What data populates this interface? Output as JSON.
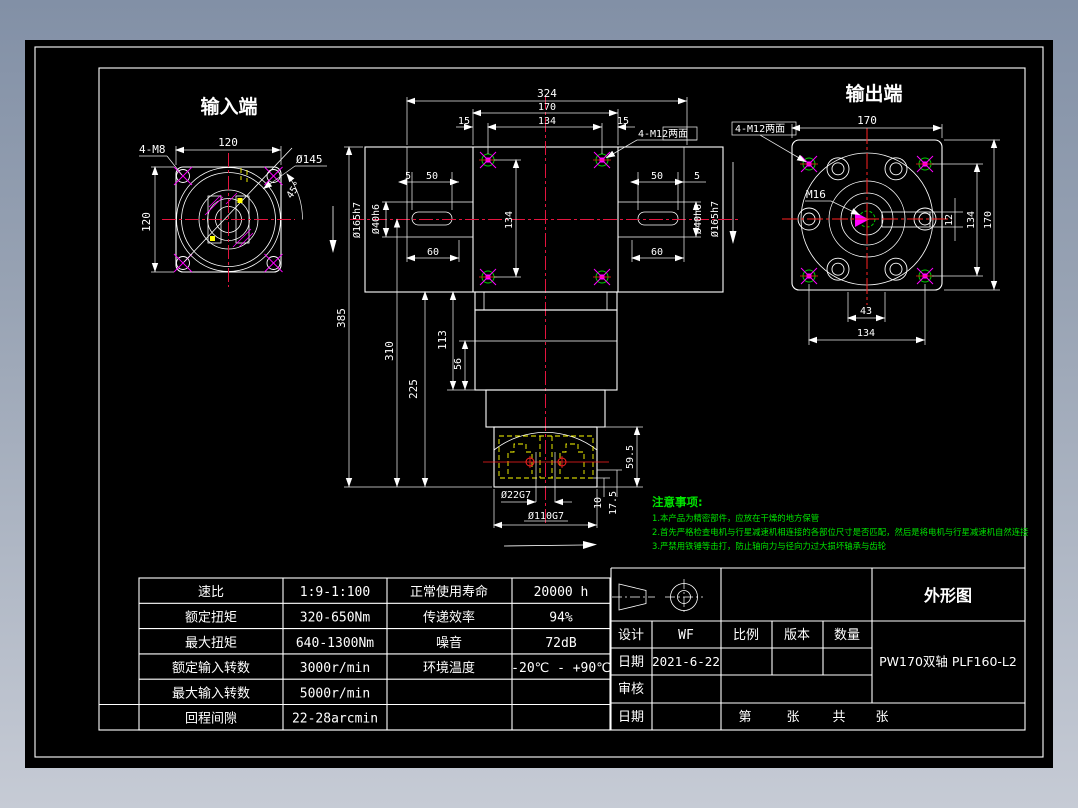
{
  "colors": {
    "background_top": "#8290a6",
    "background_bottom": "#c6cbd5",
    "canvas": "#000000",
    "line_white": "#ffffff",
    "centerline_red": "#e3143f",
    "hatch_magenta": "#ff00ff",
    "hidden_yellow": "#ffff00",
    "hole_green": "#00cc00",
    "note_green": "#00e400"
  },
  "views": {
    "input": {
      "title": "输入端",
      "dim_width": "120",
      "dim_height": "120",
      "label_bolts": "4-M8",
      "label_bolt_circle": "Ø145",
      "label_angle": "45°"
    },
    "front": {
      "dim_overall_width": "324",
      "dim_flange_width": "170",
      "dim_hole_spacing_h": "134",
      "dim_offset_left": "15",
      "dim_offset_right": "15",
      "label_bolts": "4-M12两面",
      "dim_slot_left_5": "5",
      "dim_slot_left_50": "50",
      "dim_slot_left_60": "60",
      "dim_slot_right_50": "50",
      "dim_slot_right_5": "5",
      "dim_slot_right_60": "60",
      "dim_spigot_left": "Ø165h7",
      "dim_bore_left": "Ø40h6",
      "dim_bore_right": "Ø40h6",
      "dim_spigot_right": "Ø165h7",
      "dim_hole_spacing_v": "134",
      "dim_total_height": "385",
      "dim_height_310": "310",
      "dim_height_225": "225",
      "dim_height_113": "113",
      "dim_height_56": "56",
      "dim_height_59_5": "59.5",
      "dim_height_10": "10",
      "dim_height_17_5": "17.5",
      "dim_bore_22": "Ø22G7",
      "dim_bore_110": "Ø110G7"
    },
    "output": {
      "title": "输出端",
      "label_bolts": "4-M12两面",
      "dim_width": "170",
      "label_thread": "M16",
      "dim_key_width": "12",
      "dim_hole_spacing_v": "134",
      "dim_height": "170",
      "dim_shaft_43": "43",
      "dim_hole_spacing_b": "134"
    }
  },
  "notes": {
    "title": "注意事项:",
    "line1": "1.本产品为精密部件，应放在干燥的地方保管",
    "line2": "2.首先严格检查电机与行星减速机相连接的各部位尺寸是否匹配，然后是将电机与行星减速机自然连接",
    "line3": "3.严禁用铁锤等击打，防止轴向力与径向力过大损坏轴承与齿轮"
  },
  "spec_table": {
    "rows": [
      [
        "速比",
        "1:9-1:100",
        "正常使用寿命",
        "20000 h"
      ],
      [
        "额定扭矩",
        "320-650Nm",
        "传递效率",
        "94%"
      ],
      [
        "最大扭矩",
        "640-1300Nm",
        "噪音",
        "72dB"
      ],
      [
        "额定输入转数",
        "3000r/min",
        "环境温度",
        "-20℃ - +90℃"
      ],
      [
        "最大输入转数",
        "5000r/min",
        "",
        ""
      ],
      [
        "回程间隙",
        "22-28arcmin",
        "",
        ""
      ]
    ]
  },
  "title_block": {
    "doc_type": "外形图",
    "design_label": "设计",
    "designer": "WF",
    "scale_label": "比例",
    "version_label": "版本",
    "qty_label": "数量",
    "date_label": "日期",
    "date": "2021-6-22",
    "model": "PW170双轴 PLF160-L2",
    "check_label": "审核",
    "date2_label": "日期",
    "sheet_labels": [
      "第",
      "张",
      "共",
      "张"
    ]
  }
}
